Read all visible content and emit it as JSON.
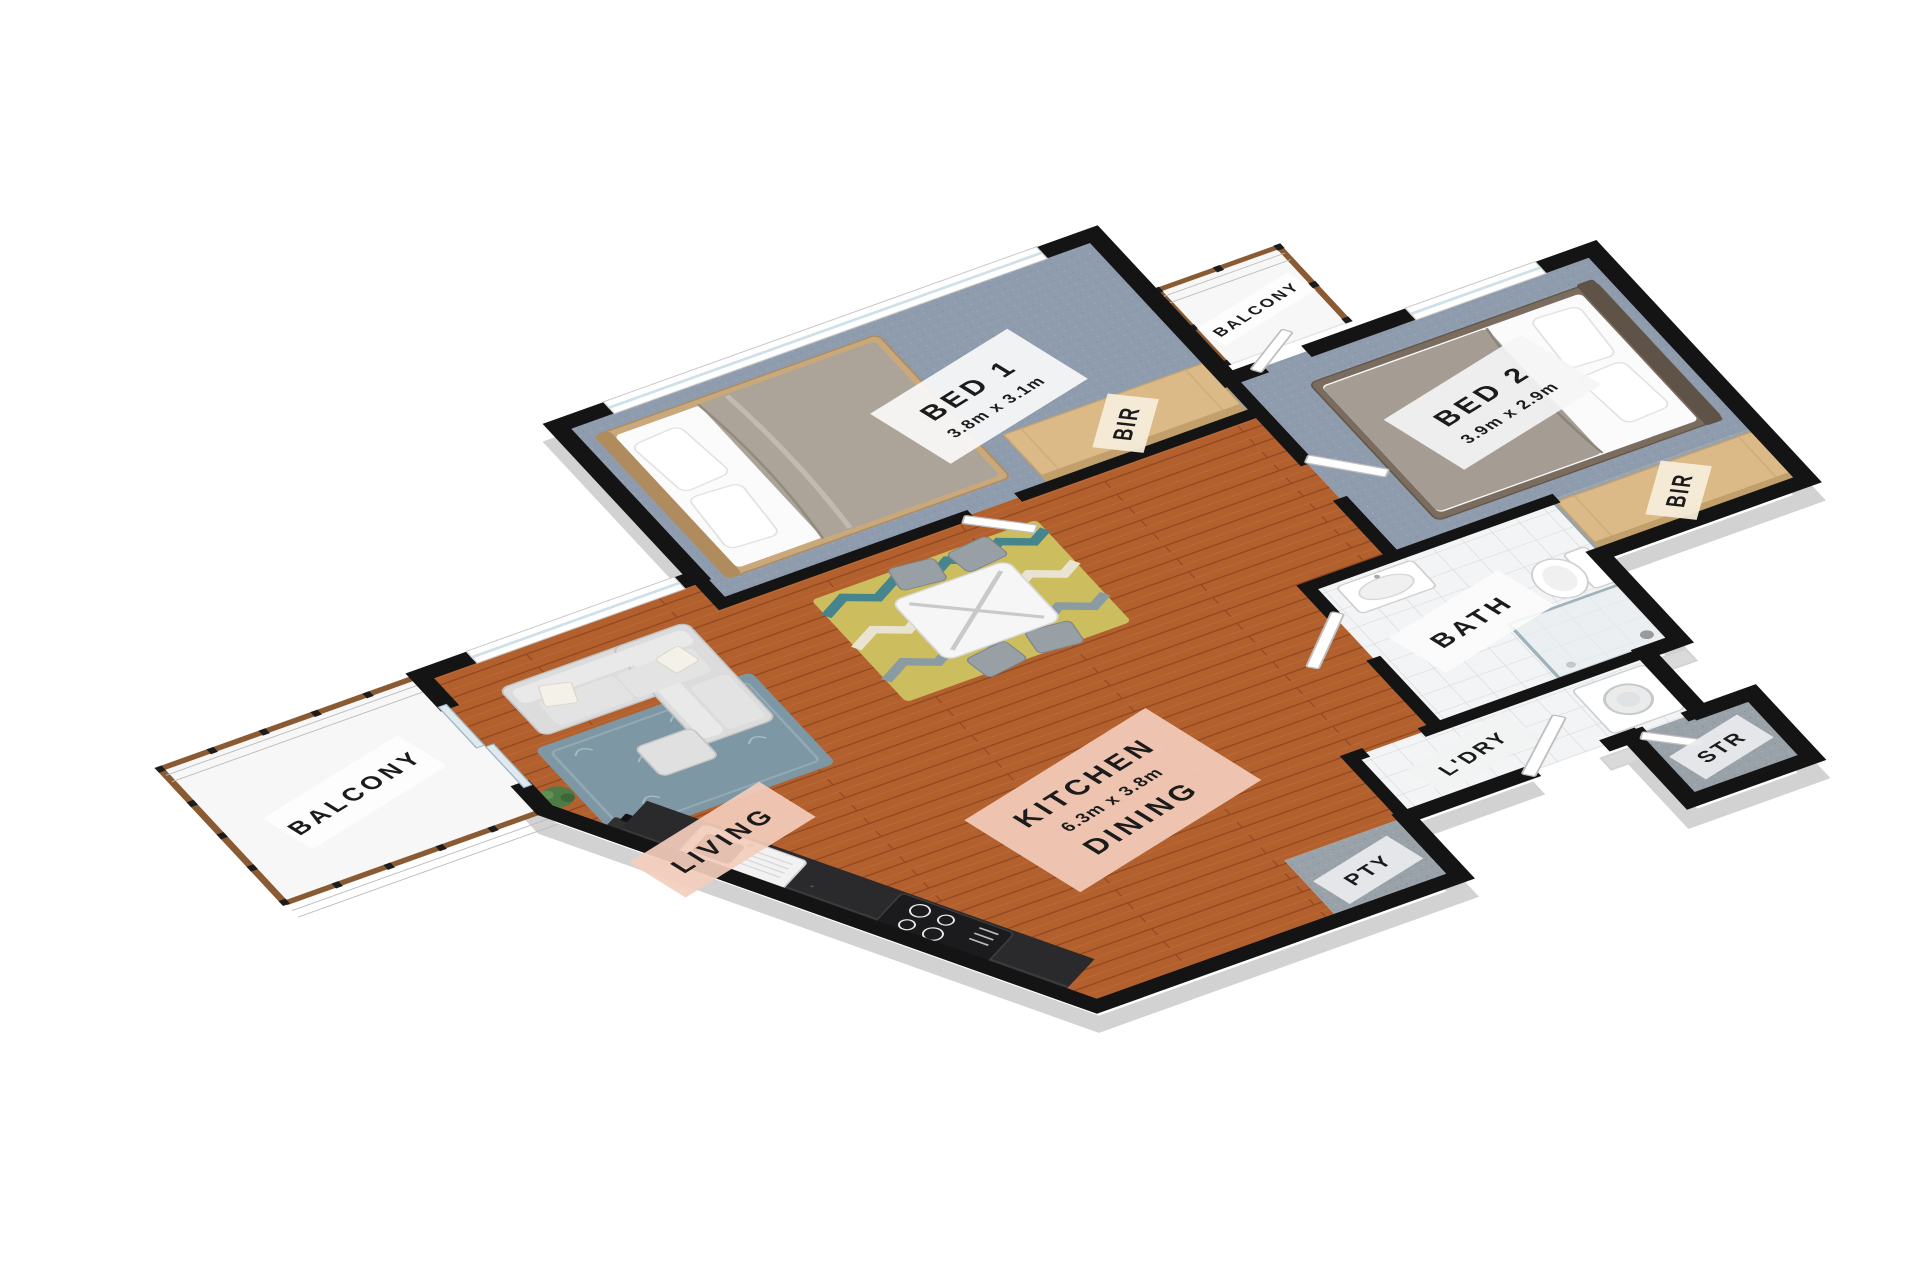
{
  "page": {
    "background": "#ffffff",
    "view": "3D floor plan render"
  },
  "colors": {
    "wall_top": "#141414",
    "wall_side": "#d6d6d6",
    "timber_floor": "#b2602e",
    "carpet": "#8f9cad",
    "tile": "#f3f4f5",
    "grey_carpet": "#99a1a9",
    "balcony_floor": "#f7f7f7",
    "counter_stone": "#2a2a2c",
    "wardrobe_wood": "#dcba87",
    "placard_warm": "#f3cdbc",
    "placard_light": "#fafafa",
    "rug_living": "#7d98a4",
    "rug_dining": "#ccbd5e",
    "handrail": "#8a5a33"
  },
  "rooms": [
    {
      "id": "balcony",
      "label": "BALCONY"
    },
    {
      "id": "living",
      "label": "LIVING"
    },
    {
      "id": "kitchen-dining",
      "label": "KITCHEN",
      "dimensions": "6.3m x 3.8m",
      "label2": "DINING"
    },
    {
      "id": "bed-1",
      "label": "BED 1",
      "dimensions": "3.8m x 3.1m"
    },
    {
      "id": "bed-2",
      "label": "BED 2",
      "dimensions": "3.9m x 2.9m"
    },
    {
      "id": "bir-bed1",
      "label": "BIR"
    },
    {
      "id": "bir-bed2",
      "label": "BIR"
    },
    {
      "id": "bath",
      "label": "BATH"
    },
    {
      "id": "laundry",
      "label": "L'DRY"
    },
    {
      "id": "pantry",
      "label": "PTY"
    },
    {
      "id": "storage",
      "label": "STR"
    },
    {
      "id": "balcony-2",
      "label": "BALCONY"
    }
  ]
}
